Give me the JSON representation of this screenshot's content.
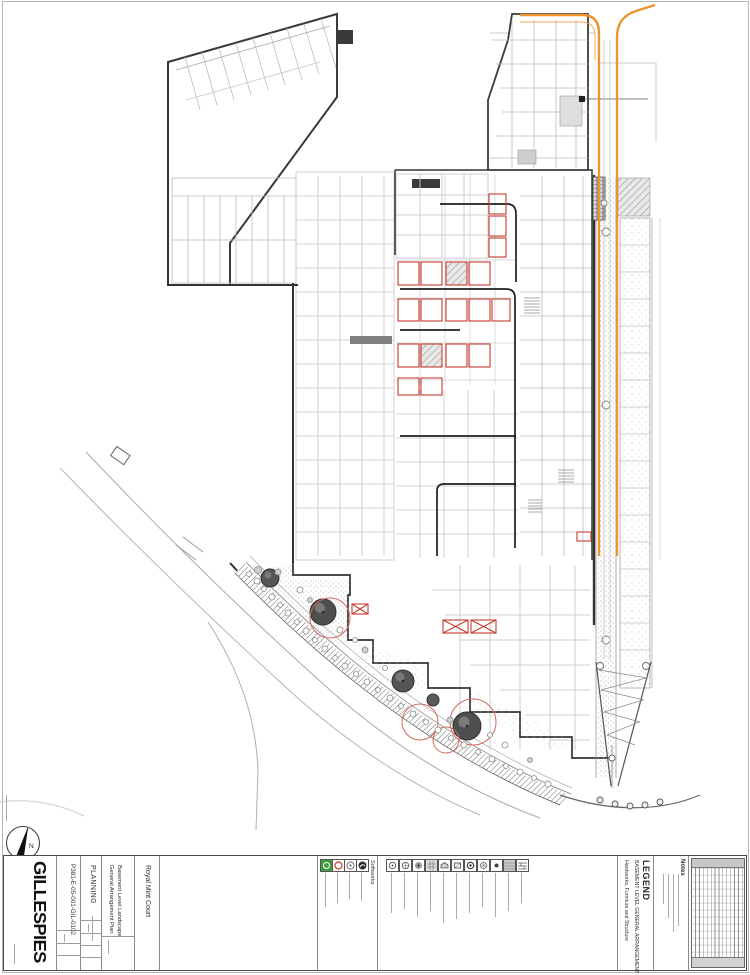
{
  "sheet": {
    "firm_logo": "GILLESPIES",
    "project": "Royal Mint Court",
    "title_line1": "Basement Level Landscape",
    "title_line2": "General Arrangement Plan",
    "status": "PLANNING",
    "drawing_number": "P381-E-05-001-GIL-0102",
    "north_label": "N"
  },
  "legend": {
    "title": "LEGEND",
    "subtitle": "BASEMENT LEVEL GENERAL ARRANGEMENT",
    "notes_title": "Notes",
    "softworks_label": "Softworks",
    "hardworks_label": "Hardworks, Furniture and Structure"
  },
  "colors": {
    "highway_orange": "#EB9531",
    "parking_red": "#C43C30",
    "tree_protection_red": "#D2685E",
    "softworks_green": "#3F9E3F",
    "canopy_gray": "#555555",
    "outline_dark": "#333333",
    "partition_gray": "#B9BDBF"
  }
}
